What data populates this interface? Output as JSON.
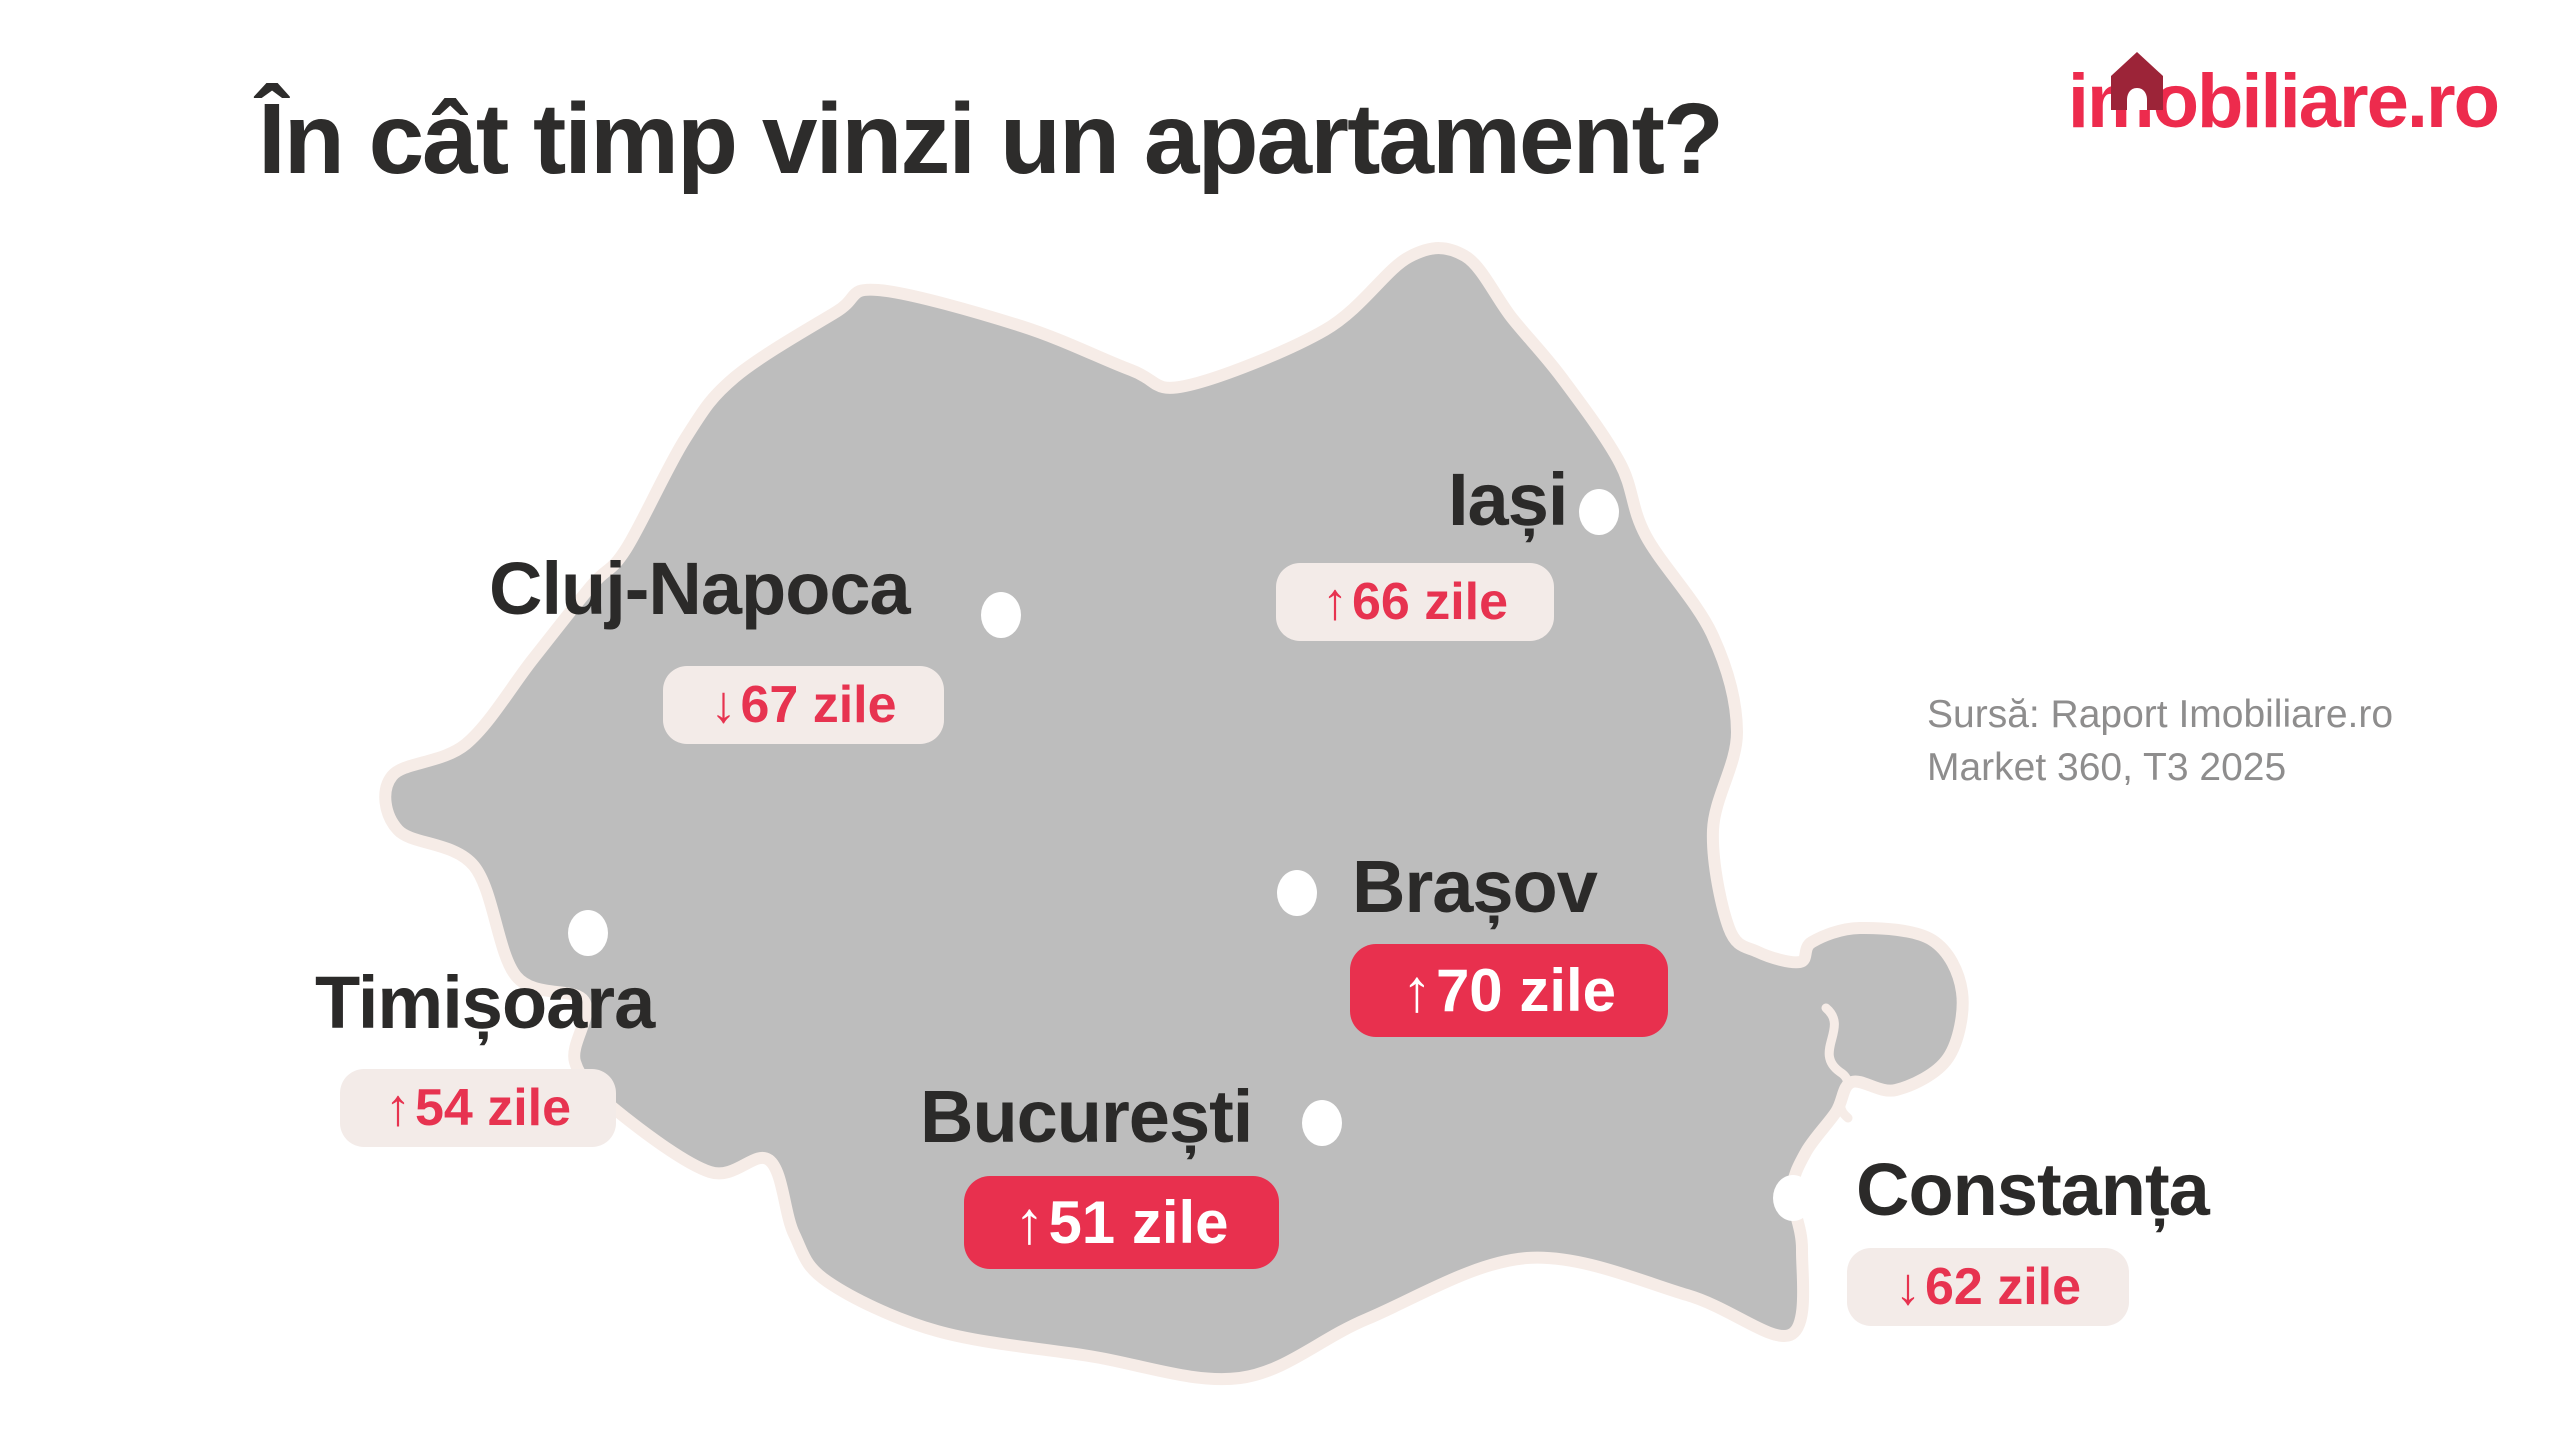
{
  "header": {
    "title": "În cât timp vinzi un apartament?",
    "logo": {
      "text_start": "i",
      "text_m": "m",
      "text_end": "obiliare.ro",
      "house_icon": "house-roof-with-door",
      "brand_red": "#ed2b4d",
      "brand_dark_red": "#9c2438"
    }
  },
  "source_note": {
    "line1": "Sursă: Raport Imobiliare.ro",
    "line2": "Market 360, T3 2025"
  },
  "map": {
    "region": "Romania",
    "fill": "#bdbdbd",
    "outline": "#f6ece7"
  },
  "cities": [
    {
      "id": "cluj-napoca",
      "name": "Cluj-Napoca",
      "arrow": "↓",
      "days": "67 zile",
      "trend": "down",
      "badge_style": "light"
    },
    {
      "id": "iasi",
      "name": "Iași",
      "arrow": "↑",
      "days": "66 zile",
      "trend": "up",
      "badge_style": "light"
    },
    {
      "id": "timisoara",
      "name": "Timișoara",
      "arrow": "↑",
      "days": "54 zile",
      "trend": "up",
      "badge_style": "light"
    },
    {
      "id": "brasov",
      "name": "Brașov",
      "arrow": "↑",
      "days": "70 zile",
      "trend": "up",
      "badge_style": "red"
    },
    {
      "id": "bucuresti",
      "name": "București",
      "arrow": "↑",
      "days": "51 zile",
      "trend": "up",
      "badge_style": "red"
    },
    {
      "id": "constanta",
      "name": "Constanța",
      "arrow": "↓",
      "days": "62 zile",
      "trend": "down",
      "badge_style": "light"
    }
  ],
  "colors": {
    "accent_red": "#e73350",
    "badge_red_bg": "#e8304e",
    "badge_light_bg": "#f3ebe8",
    "text_dark": "#2b2a29",
    "text_gray": "#8e8d8d",
    "map_gray": "#bdbdbd",
    "map_outline_cream": "#f6ece7"
  },
  "chart_data": {
    "type": "table",
    "title": "În cât timp vinzi un apartament?",
    "columns": [
      "Oraș",
      "Zile",
      "Trend"
    ],
    "rows": [
      [
        "Cluj-Napoca",
        67,
        "down"
      ],
      [
        "Iași",
        66,
        "up"
      ],
      [
        "Timișoara",
        54,
        "up"
      ],
      [
        "Brașov",
        70,
        "up"
      ],
      [
        "București",
        51,
        "up"
      ],
      [
        "Constanța",
        62,
        "down"
      ]
    ],
    "source": "Sursă: Raport Imobiliare.ro Market 360, T3 2025"
  }
}
